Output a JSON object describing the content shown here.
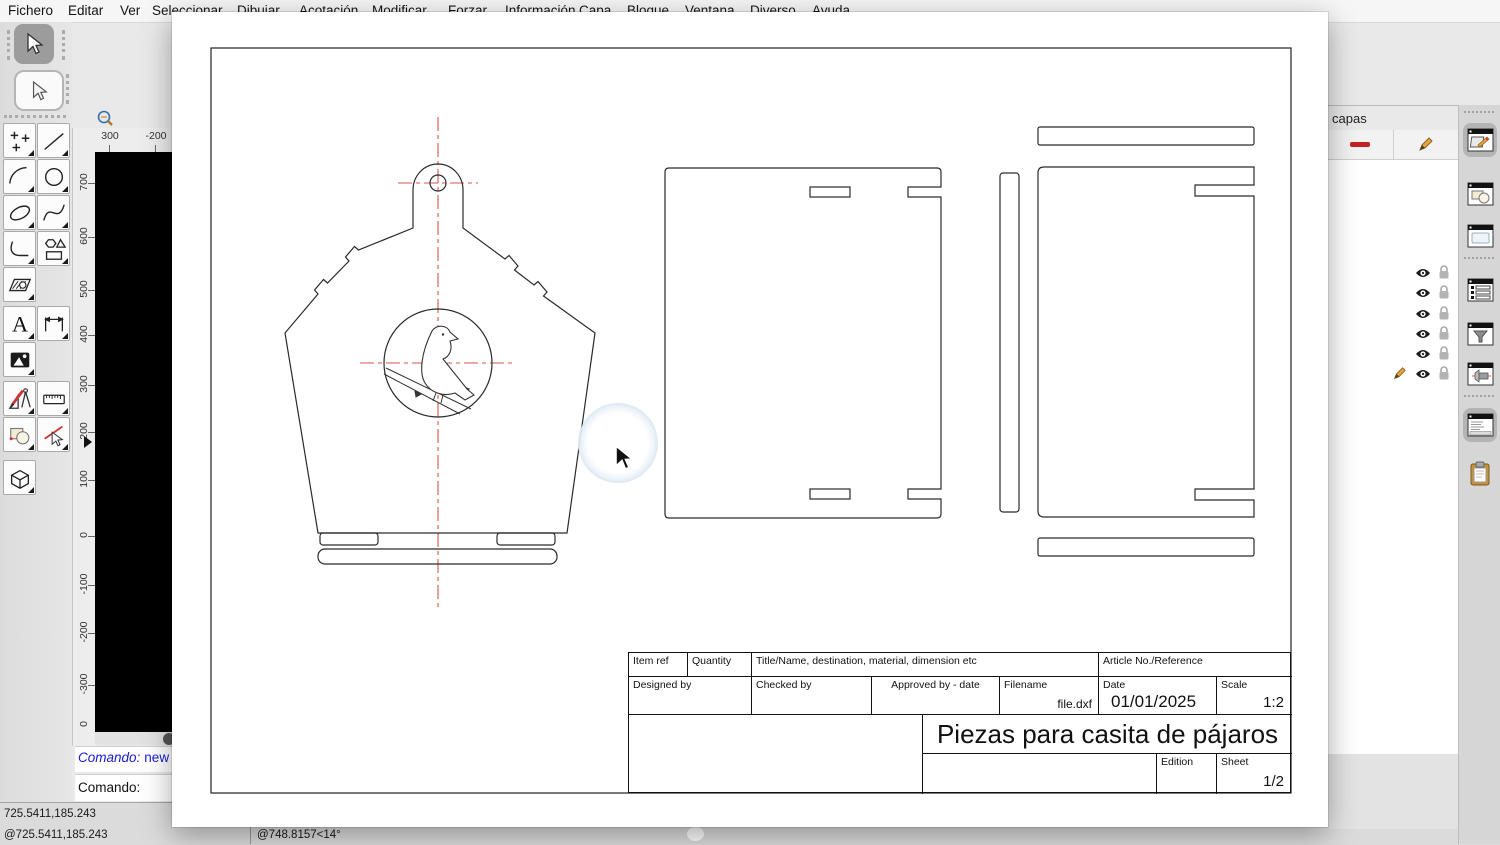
{
  "menu": {
    "items": [
      "Fichero",
      "Editar",
      "Ver",
      "Seleccionar",
      "Dibujar",
      "Acotación",
      "Modificar",
      "Forzar",
      "Información",
      "Capa",
      "Bloque",
      "Ventana",
      "Diverso",
      "Ayuda"
    ]
  },
  "left_toolbar": {
    "tools": [
      "selection-arrow-icon",
      "selection-arrow-icon",
      "point-tool-icon",
      "line-tool-icon",
      "arc-tool-icon",
      "circle-tool-icon",
      "ellipse-tool-icon",
      "spline-tool-icon",
      "polyline-tool-icon",
      "polygon-tool-icon",
      "hatch-tool-icon",
      "text-tool-icon",
      "dimension-tool-icon",
      "image-tool-icon",
      "draft-tool-icon",
      "measure-tool-icon",
      "modify-tool-icon",
      "delete-tool-icon",
      "box-3d-tool-icon"
    ]
  },
  "rulers": {
    "horizontal": [
      "300",
      "-200"
    ],
    "vertical": [
      "700",
      "600",
      "500",
      "400",
      "300",
      "200",
      "100",
      "0",
      "-100",
      "-200",
      "-300",
      "0"
    ]
  },
  "command": {
    "history_label": "Comando:",
    "history_value": "new",
    "prompt_label": "Comando:"
  },
  "status_bar": {
    "coordinate_absolute": "725.5411,185.243",
    "coordinate_relative": "@725.5411,185.243",
    "coordinate_polar": "@748.8157<14°"
  },
  "layers_panel": {
    "title": "capas",
    "toolbar_icons": [
      "remove-layer-icon",
      "edit-layer-icon"
    ],
    "rows": [
      {
        "icons": [
          "eye-icon",
          "lock-icon"
        ]
      },
      {
        "icons": [
          "eye-icon",
          "lock-icon"
        ]
      },
      {
        "icons": [
          "eye-icon",
          "lock-icon"
        ]
      },
      {
        "icons": [
          "eye-icon",
          "lock-icon"
        ]
      },
      {
        "icons": [
          "eye-icon",
          "lock-icon"
        ]
      },
      {
        "icons": [
          "pencil-icon",
          "eye-icon",
          "lock-icon"
        ]
      }
    ]
  },
  "right_dock": {
    "icons": [
      "layer-list-window-icon",
      "block-list-window-icon",
      "library-browser-window-icon",
      "property-list-window-icon",
      "selection-filter-window-icon",
      "wall-tool-window-icon",
      "command-line-window-icon",
      "clipboard-icon"
    ]
  },
  "title_block": {
    "item_ref": "Item ref",
    "quantity": "Quantity",
    "title_name": "Title/Name, destination, material, dimension etc",
    "article_no": "Article No./Reference",
    "designed_by": "Designed by",
    "checked_by": "Checked by",
    "approved_by": "Approved by - date",
    "filename_label": "Filename",
    "filename_value": "file.dxf",
    "date_label": "Date",
    "date_value": "01/01/2025",
    "scale_label": "Scale",
    "scale_value": "1:2",
    "drawing_title": "Piezas para casita de pájaros",
    "edition_label": "Edition",
    "sheet_label": "Sheet",
    "sheet_value": "1/2"
  },
  "colors": {
    "centerline_red": "#d9544d",
    "accent_red": "#c32222",
    "command_blue": "#1b1bd1",
    "drawing_stroke": "#2a2a2a"
  }
}
